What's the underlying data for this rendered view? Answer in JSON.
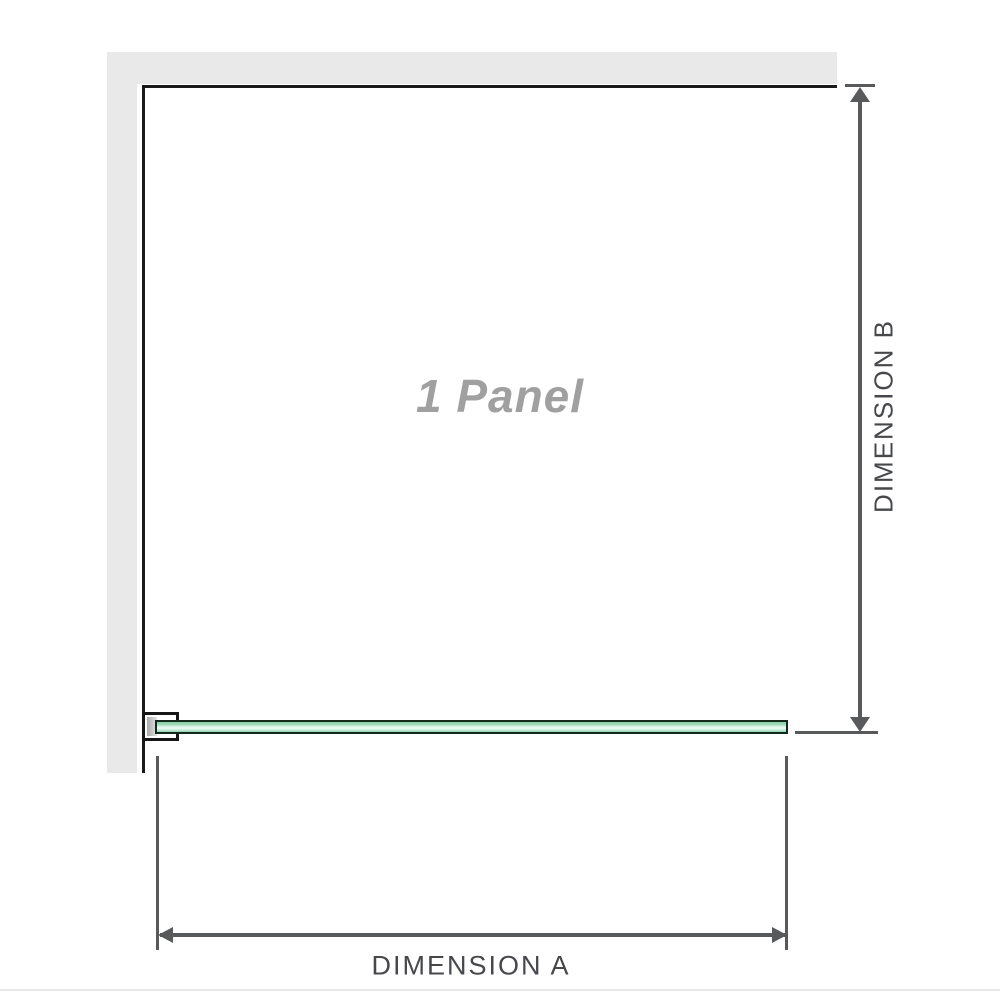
{
  "diagram": {
    "title": "Shower panel dimension diagram",
    "panel_label": "1 Panel",
    "dimension_a_label": "DIMENSION A",
    "dimension_b_label": "DIMENSION B"
  },
  "icons": {
    "arrow_up": "up-arrowhead",
    "arrow_down": "down-arrowhead",
    "arrow_left": "left-arrowhead",
    "arrow_right": "right-arrowhead"
  },
  "colors": {
    "background": "#ffffff",
    "wall_gray": "#e9e9e9",
    "panel_outline": "#1a1a1a",
    "dimension_line": "#58595b",
    "dimension_text": "#46484b",
    "watermark_text": "#a0a0a0",
    "glass_green": "#8bd1a8",
    "glass_highlight": "#f1fbf6",
    "glass_border": "#14281d",
    "bottom_divider": "#e7e7e5"
  }
}
